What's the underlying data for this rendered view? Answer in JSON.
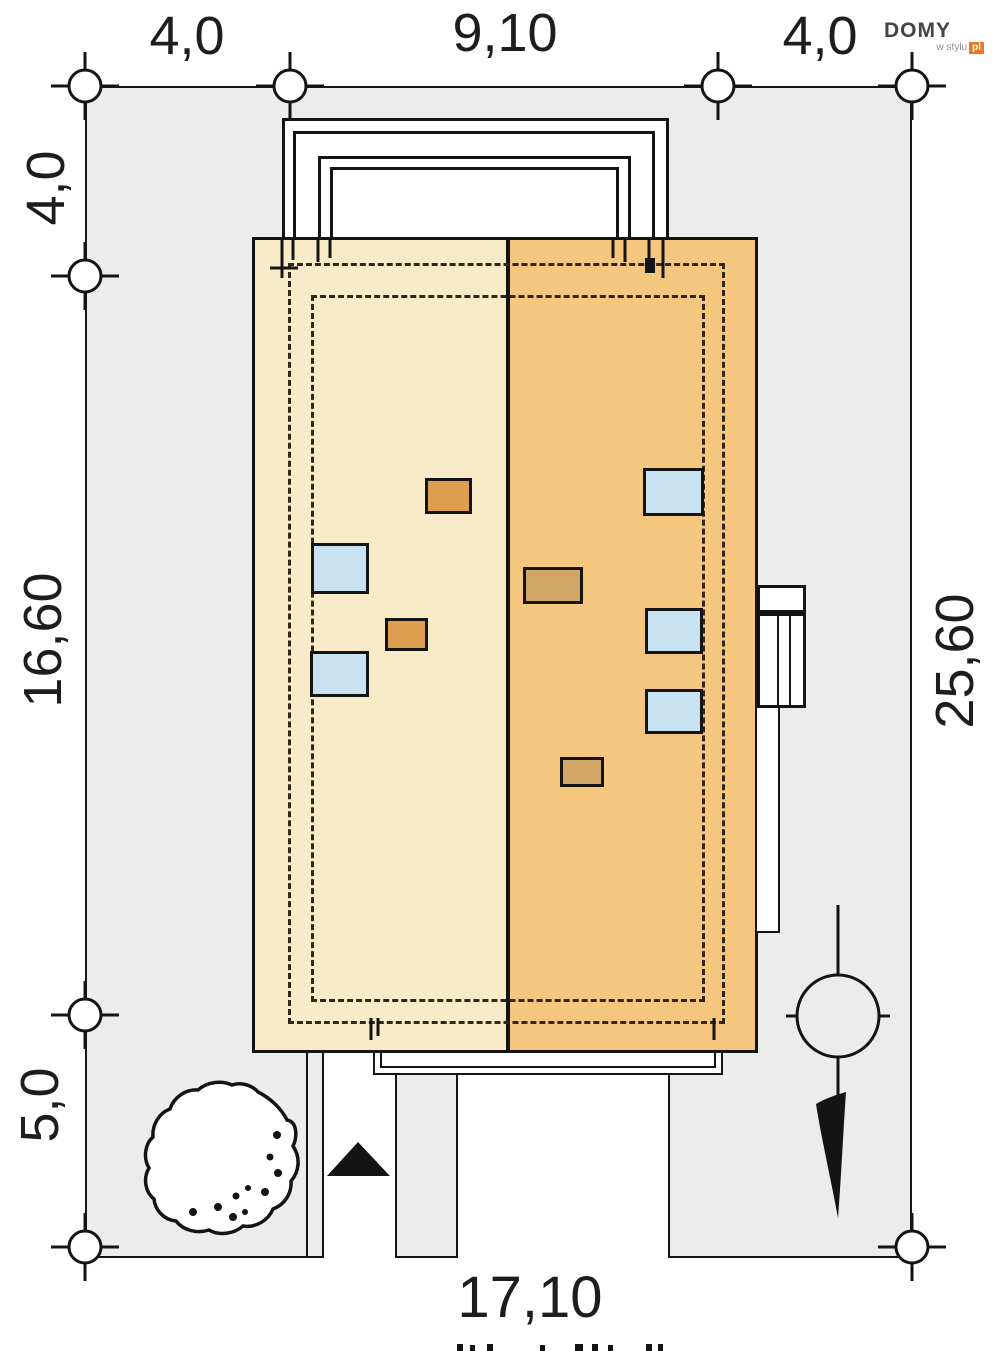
{
  "title": "Site plan of a house plot (roof view)",
  "logo": {
    "brand": "DOMY",
    "subtitle": "w stylu",
    "tld": "pl"
  },
  "dimensions": {
    "top_left": "4,0",
    "top_center": "9,10",
    "top_right": "4,0",
    "left_top": "4,0",
    "left_middle": "16,60",
    "left_bottom": "5,0",
    "right_side": "25,60",
    "bottom": "17,10"
  },
  "colors": {
    "plot_fill": "#ececec",
    "roof_left_fill": "#f8ebc8",
    "roof_right_fill": "#f5c77e",
    "skylight_fill": "#c9e2f2",
    "chimney_fill_left": "#dd9e50",
    "chimney_fill_right": "#d2a765",
    "line": "#141414",
    "dashed_wall": "#32261a",
    "logo_orange": "#ee7622"
  },
  "symbols": {
    "tree": "deciduous-tree",
    "entrance_arrow": "entrance-arrow",
    "utility_pole": "utility-pole-with-guy",
    "dimension_node": "survey-point-circle"
  }
}
